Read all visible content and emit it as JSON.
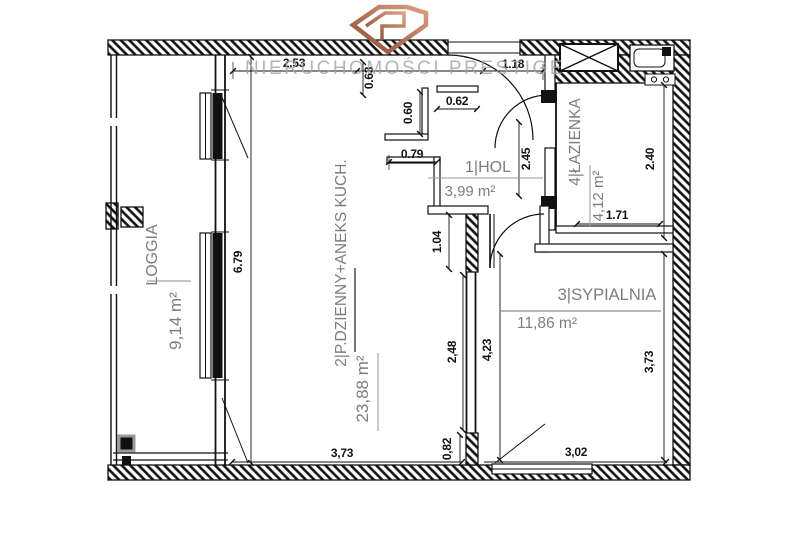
{
  "watermark": {
    "brand": "NIERUCHOMOŚCI PRESTIGE"
  },
  "logo": {
    "icon": "diamond-logo",
    "color_dark": "#8a4a32",
    "color_light": "#dba183"
  },
  "rooms": {
    "loggia": {
      "label": "LOGGIA",
      "area": "9,14 m²"
    },
    "living": {
      "label": "2|P.DZIENNY+ANEKS KUCH.",
      "area": "23,88 m²"
    },
    "hol": {
      "label": "1|HOL",
      "area": "3,99 m²"
    },
    "bathroom": {
      "label": "4|ŁAZIENKA",
      "area": "4,12 m²"
    },
    "bedroom": {
      "label": "3|SYPIALNIA",
      "area": "11,86 m²"
    }
  },
  "dimensions": {
    "living_top": "2.53",
    "niche_height": "0.63",
    "hall_top": "1.18",
    "hall_width": "0.62",
    "kitchen_height": "0.60",
    "kitchen_width": "0.79",
    "hall_height": "2.45",
    "wall_hall": "1.04",
    "living_height": "6.79",
    "wall_living": "2,48",
    "bedroom_left": "4,23",
    "bathroom_height": "2.40",
    "bathroom_width": "1.71",
    "living_width": "3,73",
    "bottom_small": "0,82",
    "bedroom_width": "3,02",
    "bedroom_height": "3,73"
  },
  "colors": {
    "wall": "#111111",
    "label_gray": "#7d7d7d",
    "watermark_gray": "#a3a3a3"
  }
}
